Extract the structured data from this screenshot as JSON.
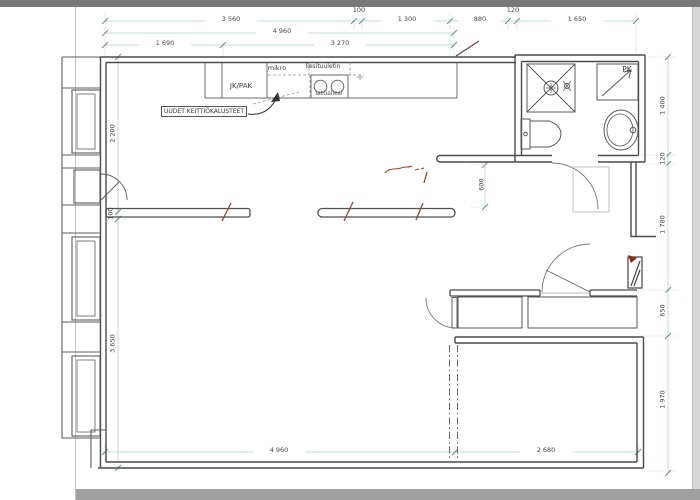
{
  "plan": {
    "kitchen": {
      "fridge_label": "JK/PAK",
      "microwave_label": "mikro",
      "hood_label": "liesituuletin",
      "stove_label": "lattialiesi",
      "note": "UUDET KEITTIÖKALUSTEET"
    },
    "bathroom": {
      "washing_machine_label": "PK"
    },
    "dimensions_mm": {
      "top_row_1": [
        "3 560",
        "100",
        "1 300",
        "880",
        "120",
        "1 650"
      ],
      "top_row_2": [
        "4 960"
      ],
      "top_row_3": [
        "1 690",
        "3 270"
      ],
      "left_side": [
        "2 200",
        "100",
        "3 650"
      ],
      "right_side": [
        "1 400",
        "120",
        "1 780",
        "650",
        "1 970"
      ],
      "hall": [
        "600"
      ],
      "bottom": [
        "4 960",
        "2 680"
      ]
    }
  },
  "colors": {
    "wall": "#4a4a4a",
    "fixture": "#5a5a5a",
    "dimension_line": "#b2d0d4",
    "dimension_tick": "#6c8d92",
    "dimension_text": "#474747",
    "redline_markup": "#9a4433",
    "page_chrome": "#787878"
  }
}
